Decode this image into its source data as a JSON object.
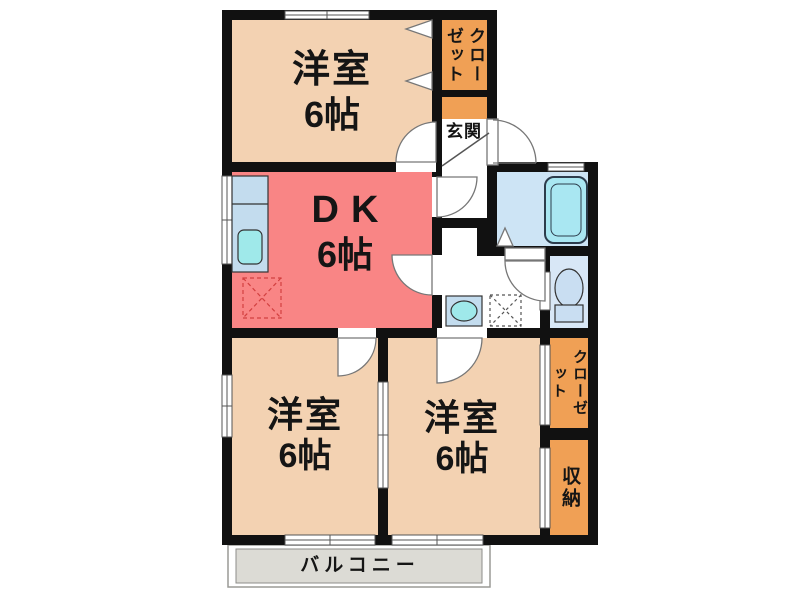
{
  "rooms": {
    "bedroom_top": {
      "label": "洋室",
      "size": "6帖"
    },
    "dining_kitchen": {
      "label": "DK",
      "size": "6帖"
    },
    "bedroom_left": {
      "label": "洋室",
      "size": "6帖"
    },
    "bedroom_right": {
      "label": "洋室",
      "size": "6帖"
    }
  },
  "areas": {
    "closet_top": "クローゼット",
    "entrance": "玄関",
    "closet_right": "クローゼット",
    "storage": "収納",
    "balcony": "バルコニー"
  },
  "fixtures": {
    "kitchen_sink": "kitchen-sink",
    "bathtub": "bathtub",
    "toilet": "toilet",
    "wash_basin": "wash-basin",
    "washing_machine_space": "washing-machine-space",
    "appliance_space": "appliance-space"
  },
  "colors": {
    "wall": "#111111",
    "bedroom": "#f3d2b2",
    "dining_kitchen": "#f98585",
    "closet": "#f0a055",
    "balcony": "#dcdbd5",
    "bathroom_floor": "#cde4f5",
    "toilet_room": "#d8e7f6",
    "water_cyan": "#9fe9ea",
    "counter_blue": "#c3dcee"
  }
}
